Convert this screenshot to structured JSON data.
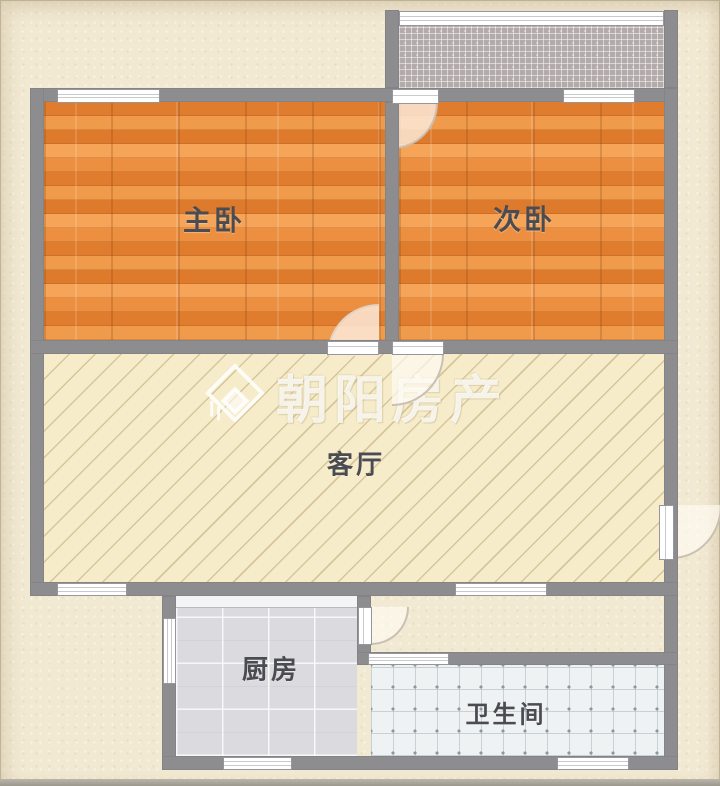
{
  "plan": {
    "watermark": {
      "text": "朝阳房产",
      "icon": "house-icon"
    },
    "rooms": {
      "master_bedroom": "主卧",
      "second_bedroom": "次卧",
      "living_room": "客厅",
      "kitchen": "厨房",
      "bathroom": "卫生间"
    },
    "colors": {
      "background": "#f2e9d2",
      "wall": "#8d8c8f",
      "wood_floor": "#e8863a",
      "living_floor": "#f6ecca",
      "kitchen_floor": "#dbdbdf",
      "bath_floor": "#eef2f2",
      "balcony_floor": "#b2abaa",
      "window_fill": "#ffffff",
      "label_text": "#4b4b52",
      "watermark_text": "rgba(255,255,255,0.78)"
    }
  }
}
